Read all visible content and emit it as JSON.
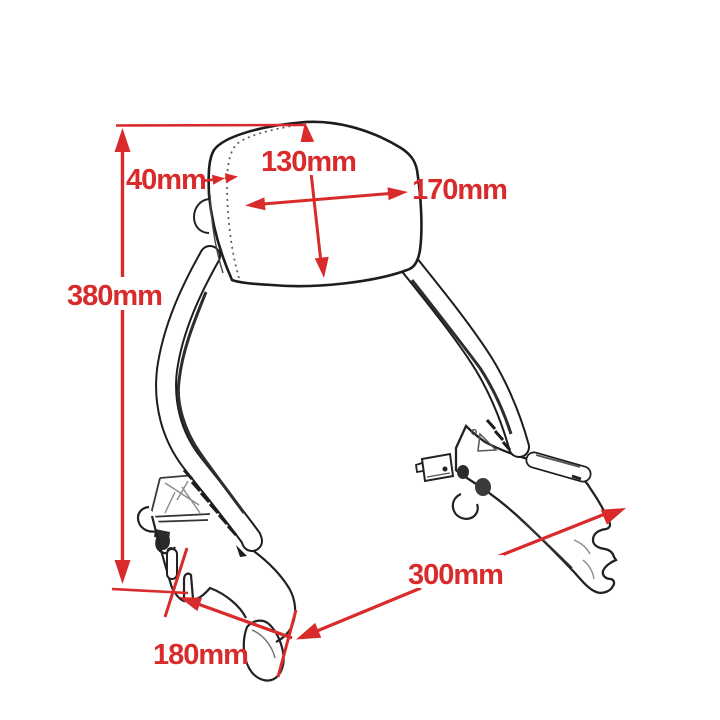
{
  "figure": {
    "figure_type": "technical-dimension-drawing",
    "subject": "sissy-bar-backrest-with-mounting-brackets",
    "units": "mm",
    "colors": {
      "background": "#ffffff",
      "line_art": "#1d1d1d",
      "annotation_red": "#d92b2b"
    },
    "dimensions": [
      {
        "id": "pad-thickness",
        "label": "40mm",
        "value": 40
      },
      {
        "id": "pad-height",
        "label": "130mm",
        "value": 130
      },
      {
        "id": "pad-width",
        "label": "170mm",
        "value": 170
      },
      {
        "id": "overall-height",
        "label": "380mm",
        "value": 380
      },
      {
        "id": "mount-span",
        "label": "300mm",
        "value": 300
      },
      {
        "id": "mount-offset",
        "label": "180mm",
        "value": 180
      }
    ]
  }
}
